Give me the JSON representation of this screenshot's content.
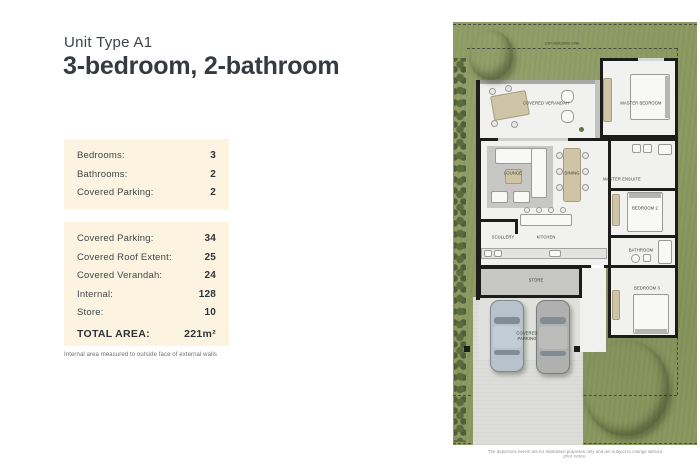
{
  "header": {
    "unit_label": "Unit Type A1",
    "title": "3-bedroom, 2-bathroom"
  },
  "spec_box": {
    "rows": [
      {
        "label": "Bedrooms:",
        "value": "3"
      },
      {
        "label": "Bathrooms:",
        "value": "2"
      },
      {
        "label": "Covered Parking:",
        "value": "2"
      }
    ]
  },
  "area_box": {
    "rows": [
      {
        "label": "Covered Parking:",
        "value": "34"
      },
      {
        "label": "Covered Roof Extent:",
        "value": "25"
      },
      {
        "label": "Covered Verandah:",
        "value": "24"
      },
      {
        "label": "Internal:",
        "value": "128"
      },
      {
        "label": "Store:",
        "value": "10"
      }
    ],
    "total": {
      "label": "TOTAL AREA:",
      "value": "221m²"
    }
  },
  "footnote": "Internal area measured to outside face of external walls",
  "plan": {
    "rooms": {
      "covered_verandah": "COVERED VERANDAH",
      "master_bedroom": "MASTER BEDROOM",
      "lounge": "LOUNGE",
      "dining": "DINING",
      "master_ensuite": "MASTER ENSUITE",
      "bedroom2": "BEDROOM 2",
      "scullery": "SCULLERY",
      "kitchen": "KITCHEN",
      "bathroom": "BATHROOM",
      "store": "STORE",
      "bedroom3": "BEDROOM 3",
      "covered_parking": "COVERED PARKING"
    },
    "site": {
      "building_line_top": "3.5m BUILDING LINE",
      "building_line_bottom": "3m BUILDING LINE"
    },
    "disclaimer": "The depictions herein are for illustration purposes only and are subject to change without prior notice."
  },
  "colors": {
    "cream_box": "#fcf4e0",
    "ink": "#3d4347",
    "grass": "#8e9a62",
    "wall": "#1c1c1a",
    "driveway": "#dcdcd8"
  }
}
